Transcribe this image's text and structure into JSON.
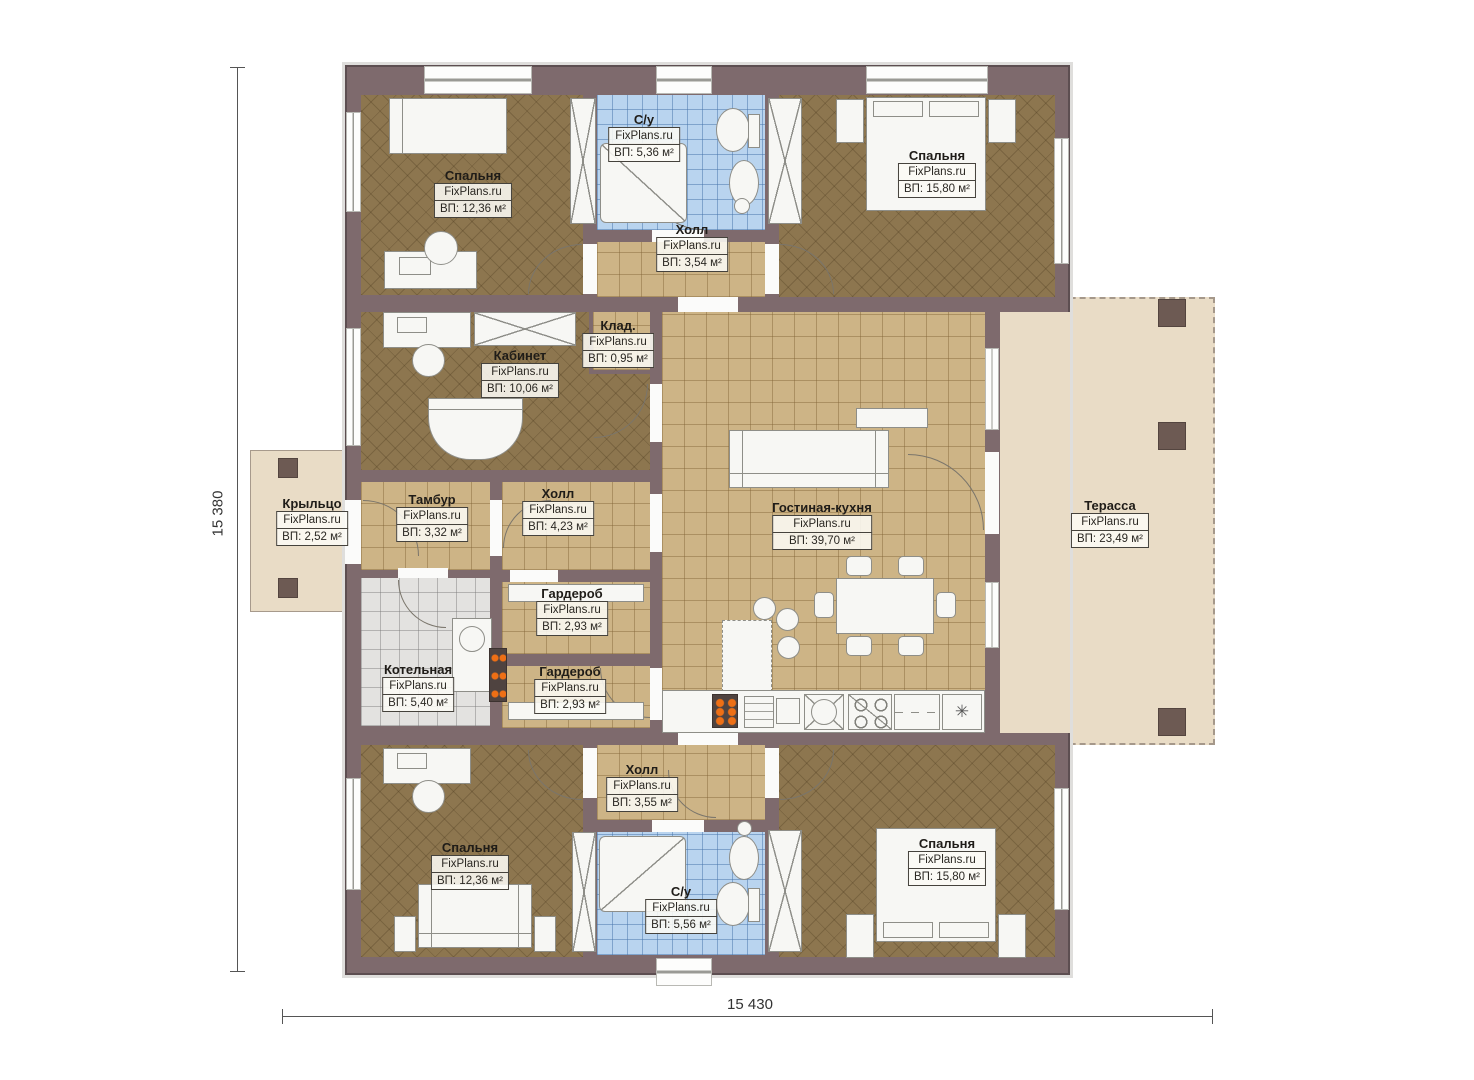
{
  "plan": {
    "dimensions": {
      "left": "15 380",
      "bottom": "15 430"
    },
    "icons": {
      "fridge_snowflake": "✳"
    },
    "colors": {
      "wall": "#7e6a6d",
      "floor_wood": "#8d764f",
      "floor_tile_tan": "#cdb486",
      "floor_tile_blue": "#b9d4ef",
      "floor_tile_gray": "#e3e2e0",
      "terrace": "#e9dcc6",
      "radiator_accent": "#ee6f15"
    },
    "rooms": [
      {
        "name": "Спальня",
        "watermark": "FixPlans.ru",
        "area": "ВП: 12,36 м²"
      },
      {
        "name": "С/у",
        "watermark": "FixPlans.ru",
        "area": "ВП: 5,36 м²"
      },
      {
        "name": "Холл",
        "watermark": "FixPlans.ru",
        "area": "ВП: 3,54 м²"
      },
      {
        "name": "Спальня",
        "watermark": "FixPlans.ru",
        "area": "ВП: 15,80 м²"
      },
      {
        "name": "Клад.",
        "watermark": "FixPlans.ru",
        "area": "ВП: 0,95 м²"
      },
      {
        "name": "Кабинет",
        "watermark": "FixPlans.ru",
        "area": "ВП: 10,06 м²"
      },
      {
        "name": "Крыльцо",
        "watermark": "FixPlans.ru",
        "area": "ВП: 2,52 м²"
      },
      {
        "name": "Тамбур",
        "watermark": "FixPlans.ru",
        "area": "ВП: 3,32 м²"
      },
      {
        "name": "Холл",
        "watermark": "FixPlans.ru",
        "area": "ВП: 4,23 м²"
      },
      {
        "name": "Гостиная-кухня",
        "watermark": "FixPlans.ru",
        "area": "ВП: 39,70 м²"
      },
      {
        "name": "Терасса",
        "watermark": "FixPlans.ru",
        "area": "ВП: 23,49 м²"
      },
      {
        "name": "Гардероб",
        "watermark": "FixPlans.ru",
        "area": "ВП: 2,93 м²"
      },
      {
        "name": "Котельная",
        "watermark": "FixPlans.ru",
        "area": "ВП: 5,40 м²"
      },
      {
        "name": "Гардероб",
        "watermark": "FixPlans.ru",
        "area": "ВП: 2,93 м²"
      },
      {
        "name": "Холл",
        "watermark": "FixPlans.ru",
        "area": "ВП: 3,55 м²"
      },
      {
        "name": "Спальня",
        "watermark": "FixPlans.ru",
        "area": "ВП: 12,36 м²"
      },
      {
        "name": "С/у",
        "watermark": "FixPlans.ru",
        "area": "ВП: 5,56 м²"
      },
      {
        "name": "Спальня",
        "watermark": "FixPlans.ru",
        "area": "ВП: 15,80 м²"
      }
    ]
  }
}
